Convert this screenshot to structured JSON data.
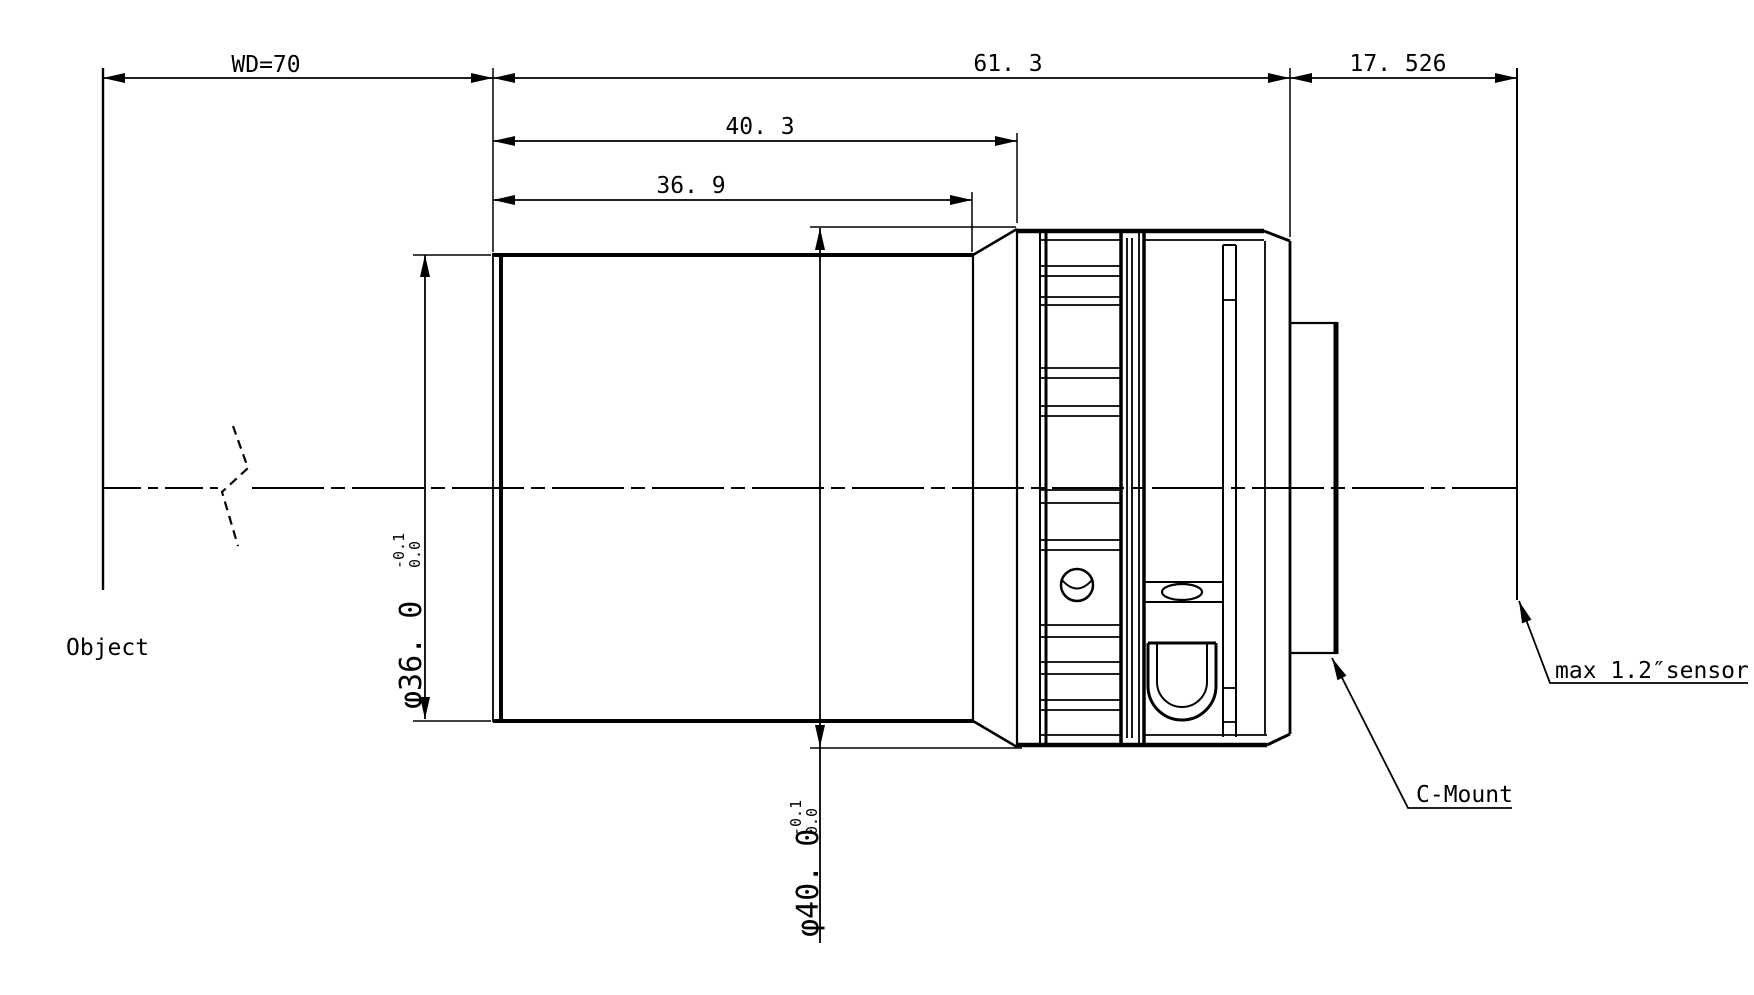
{
  "drawing": {
    "type": "lens mechanical drawing",
    "colors": {
      "line": "#000000",
      "background": "#ffffff"
    },
    "dimensions": {
      "working_distance": "WD=70",
      "overall_length": "61. 3",
      "flange_focal_distance": "17. 526",
      "front_to_ring": "40. 3",
      "front_barrel_length": "36. 9",
      "front_barrel_diameter": {
        "text": "φ36. 0",
        "tol_upper": "0.0",
        "tol_lower": "-0.1"
      },
      "ring_diameter": {
        "text": "φ40. 0",
        "tol_upper": "0.0",
        "tol_lower": "-0.1"
      }
    },
    "labels": {
      "object_plane": "Object",
      "mount": "C-Mount",
      "sensor": "max 1.2″sensor"
    }
  }
}
